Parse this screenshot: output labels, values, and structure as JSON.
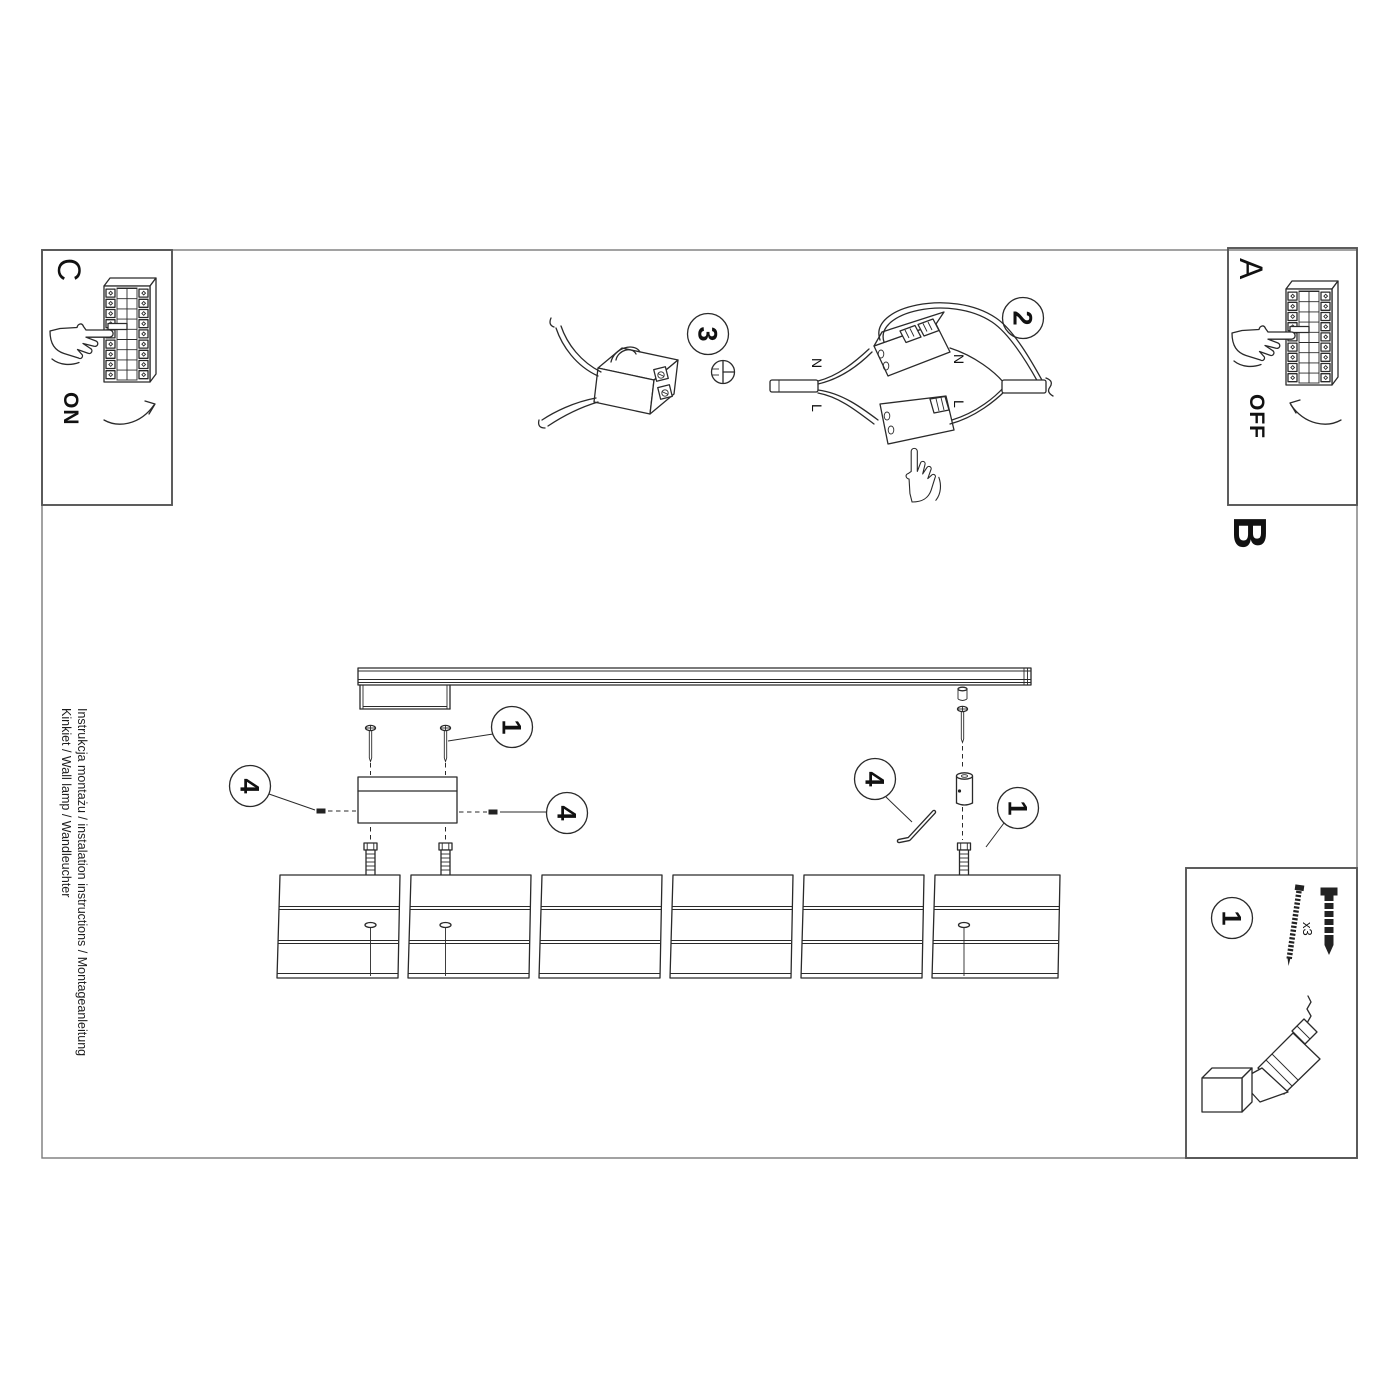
{
  "doc": {
    "title_line1": "Instrukcja montażu / instalation instructions / Montageanleitung",
    "title_line2": "Kinkiet / Wall lamp / Wandleuchter"
  },
  "sections": {
    "a_label": "A",
    "b_label": "B",
    "c_label": "C",
    "power_on": "ON",
    "power_off": "OFF"
  },
  "steps": {
    "s1": "1",
    "s2": "2",
    "s3": "3",
    "s4": "4"
  },
  "wires": {
    "neutral": "N",
    "live": "L"
  },
  "kit": {
    "screw_count": "x3"
  },
  "icons": {
    "breaker_panel": "circuit-breaker-panel",
    "pointing_hand": "pointing-hand",
    "flat_screwdriver": "flat-screwdriver-bit",
    "allen_key": "allen-key",
    "drill": "cordless-drill"
  },
  "colors": {
    "line": "#2a2a2a",
    "frame": "#7a7a7a",
    "box_border": "#555555"
  }
}
